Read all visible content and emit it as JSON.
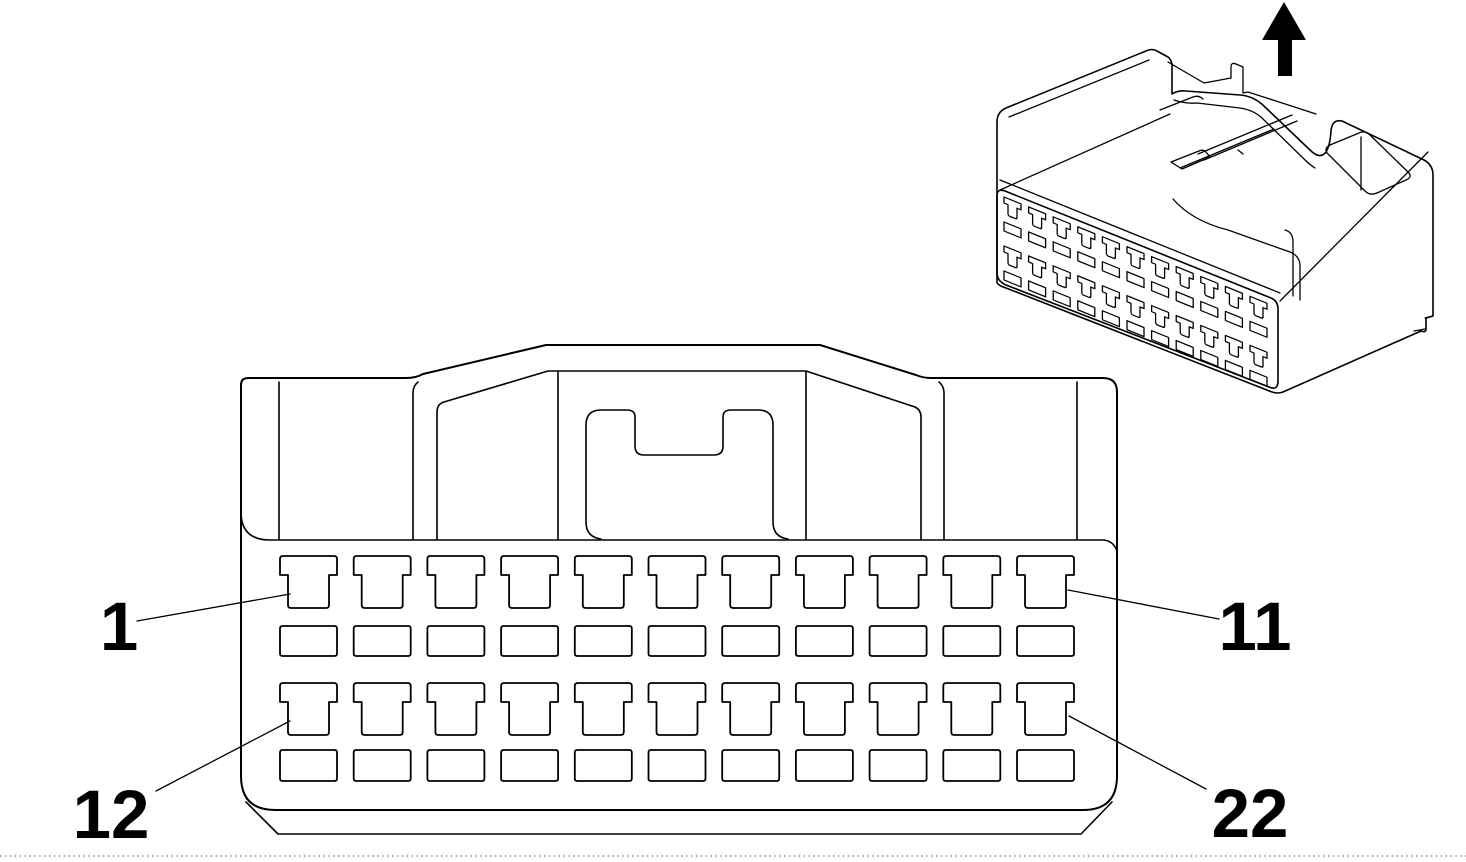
{
  "figure": {
    "kind": "connector-pinout-line-drawing",
    "background": "#ffffff",
    "line_color": "#000000"
  },
  "labels": {
    "pin_top_first": "1",
    "pin_top_last": "11",
    "pin_bottom_first": "12",
    "pin_bottom_last": "22"
  },
  "front_view": {
    "columns": 11,
    "terminal_rows": 2,
    "window_rows": 2,
    "row_order": [
      "terminal",
      "window",
      "terminal",
      "window"
    ]
  },
  "iso_view": {
    "slot_columns": 11,
    "slot_rows": 4,
    "arrow_direction": "up"
  },
  "colors": {
    "line": "#000000",
    "background": "#ffffff",
    "arrow_fill": "#000000"
  }
}
